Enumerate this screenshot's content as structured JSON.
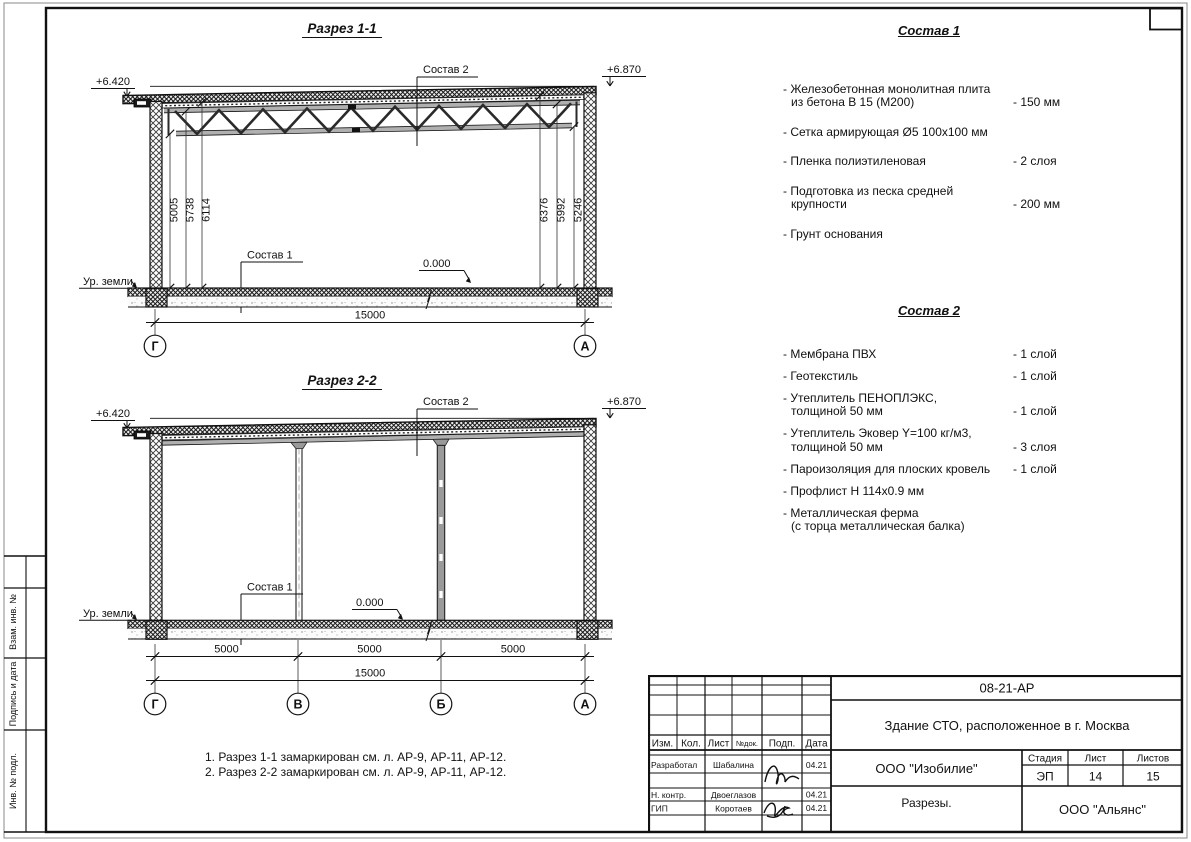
{
  "frame": {
    "side_labels": [
      "Взам. инв. №",
      "Подпись и дата",
      "Инв. № подл."
    ]
  },
  "section1": {
    "title": "Разрез 1-1",
    "elev_left": "+6.420",
    "elev_right": "+6.870",
    "sostav2_label": "Состав 2",
    "sostav1_label": "Состав 1",
    "zero_mark": "0.000",
    "ground_label": "Ур. земли",
    "dims_left": [
      "5005",
      "5738",
      "6114"
    ],
    "dims_right": [
      "6376",
      "5992",
      "5246"
    ],
    "dim_total": "15000",
    "axis_left": "Г",
    "axis_right": "А"
  },
  "section2": {
    "title": "Разрез 2-2",
    "elev_left": "+6.420",
    "elev_right": "+6.870",
    "sostav2_label": "Состав 2",
    "sostav1_label": "Состав 1",
    "zero_mark": "0.000",
    "ground_label": "Ур. земли",
    "dims_bays": [
      "5000",
      "5000",
      "5000"
    ],
    "dim_total": "15000",
    "axes": [
      "Г",
      "В",
      "Б",
      "А"
    ]
  },
  "sostav1": {
    "title": "Состав 1",
    "items": [
      {
        "line1": "- Железобетонная  монолитная плита",
        "line2": "из бетона В 15 (М200)",
        "value": "- 150 мм"
      },
      {
        "line1": "- Сетка армирующая Ø5 100х100 мм",
        "value": ""
      },
      {
        "line1": "- Пленка полиэтиленовая",
        "value": "- 2 слоя"
      },
      {
        "line1": "- Подготовка из песка средней",
        "line2": "крупности",
        "value": "- 200 мм"
      },
      {
        "line1": "- Грунт основания",
        "value": ""
      }
    ]
  },
  "sostav2": {
    "title": "Состав 2",
    "items": [
      {
        "line1": "- Мембрана ПВХ",
        "value": "- 1 слой"
      },
      {
        "line1": "- Геотекстиль",
        "value": "- 1 слой"
      },
      {
        "line1": "- Утеплитель ПЕНОПЛЭКС,",
        "line2": "толщиной 50 мм",
        "value": "- 1 слой"
      },
      {
        "line1": "- Утеплитель Эковер Y=100 кг/м3,",
        "line2": "толщиной 50 мм",
        "value": "- 3 слоя"
      },
      {
        "line1": "- Пароизоляция для плоских кровель",
        "value": "- 1 слой"
      },
      {
        "line1": "- Профлист Н 114х0.9 мм",
        "value": ""
      },
      {
        "line1": "- Металлическая ферма",
        "line2": "(с торца металлическая балка)",
        "value": ""
      }
    ]
  },
  "notes": [
    "1. Разрез 1-1 замаркирован см. л. АР-9, АР-11, АР-12.",
    "2. Разрез 2-2 замаркирован см. л. АР-9, АР-11, АР-12."
  ],
  "stamp": {
    "doc_number": "08-21-АР",
    "project_title": "Здание СТО, расположенное в г. Москва",
    "cols": [
      "Изм.",
      "Кол.",
      "Лист",
      "№док.",
      "Подп.",
      "Дата"
    ],
    "rows": [
      {
        "role": "Разработал",
        "name": "Шабалина",
        "date": "04.21"
      },
      {
        "role": "Н. контр.",
        "name": "Двоеглазов",
        "date": "04.21"
      },
      {
        "role": "ГИП",
        "name": "Коротаев",
        "date": "04.21"
      }
    ],
    "company": "ООО \"Изобилие\"",
    "stage_label": "Стадия",
    "sheet_label": "Лист",
    "sheets_label": "Листов",
    "stage": "ЭП",
    "sheet": "14",
    "sheets": "15",
    "sheet_title": "Разрезы.",
    "company2": "ООО \"Альянс\""
  }
}
